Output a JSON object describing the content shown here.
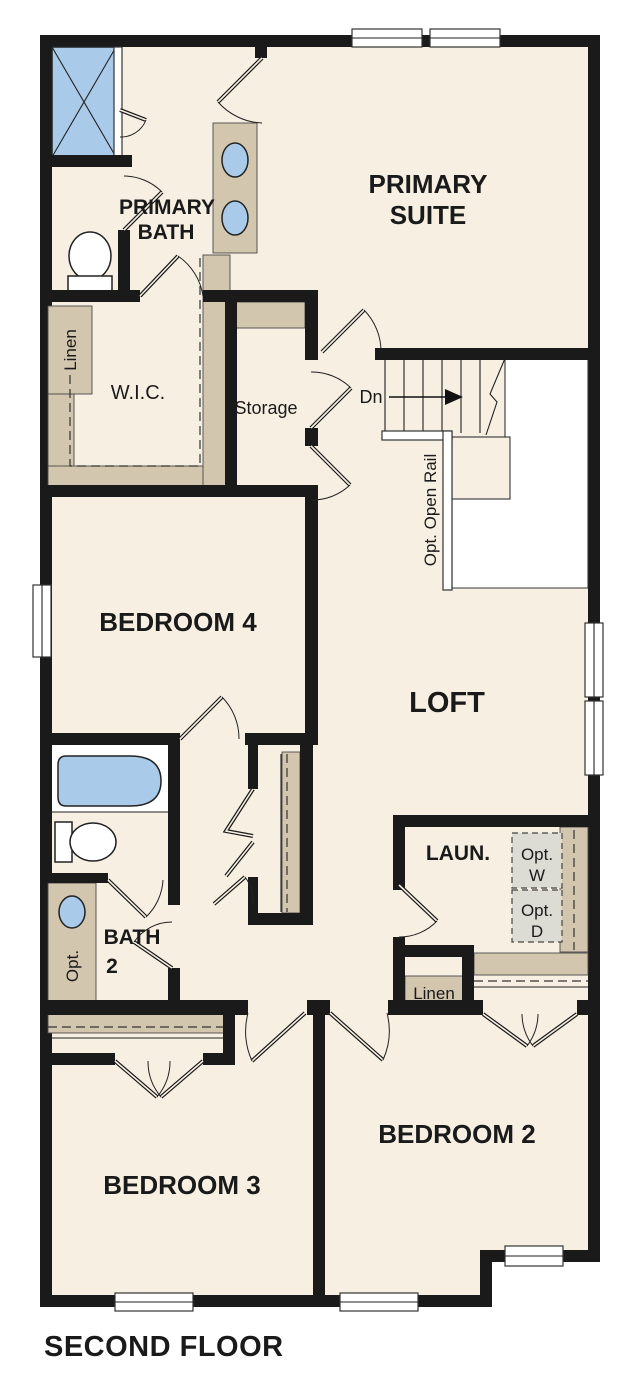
{
  "floor_title": "SECOND FLOOR",
  "colors": {
    "floor": "#f6efe2",
    "wall": "#1a1a1a",
    "casework": "#d3c6ae",
    "fixture_blue": "#a9cae8",
    "appliance_gray": "#dcdcd5",
    "void_white": "#ffffff",
    "text": "#1a1a1a"
  },
  "labels": {
    "primary_suite": [
      "PRIMARY",
      "SUITE"
    ],
    "primary_bath": [
      "PRIMARY",
      "BATH"
    ],
    "wic": "W.I.C.",
    "linen_upper": "Linen",
    "storage": "Storage",
    "stairs_down": "Dn",
    "opt_open_rail": "Opt. Open Rail",
    "bedroom4": "BEDROOM 4",
    "loft": "LOFT",
    "bath2": [
      "BATH",
      "2"
    ],
    "bath2_opt": "Opt.",
    "laundry": "LAUN.",
    "opt_washer": [
      "Opt.",
      "W"
    ],
    "opt_dryer": [
      "Opt.",
      "D"
    ],
    "linen_lower": "Linen",
    "bedroom3": "BEDROOM 3",
    "bedroom2": "BEDROOM 2"
  }
}
